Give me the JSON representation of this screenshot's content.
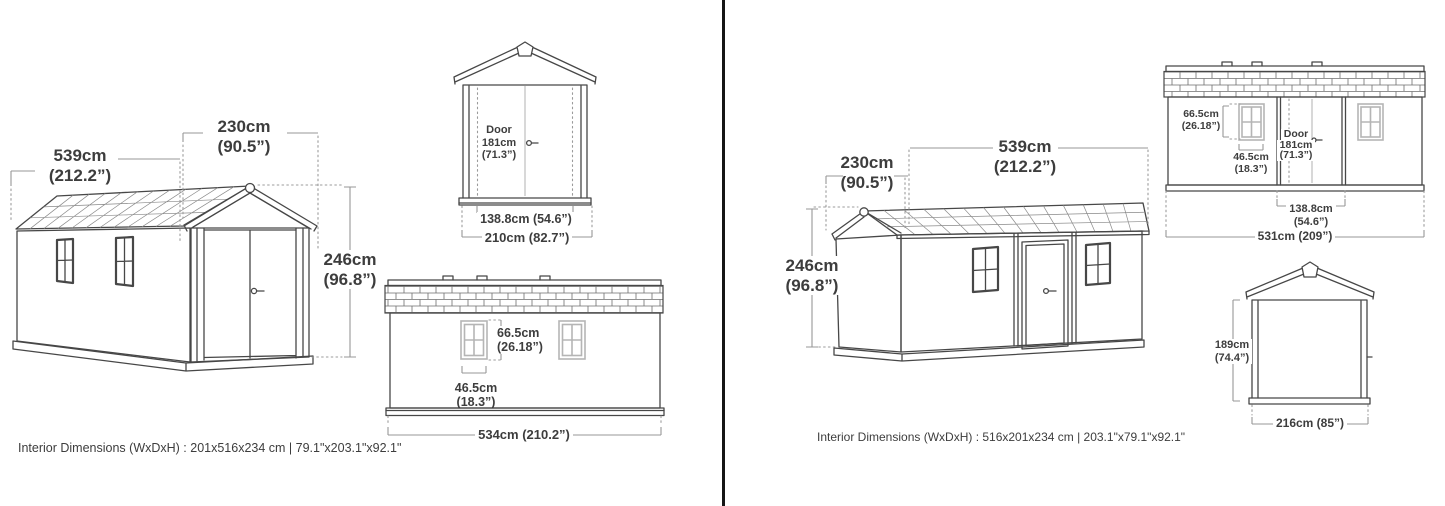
{
  "left": {
    "iso": {
      "length_cm": "539cm",
      "length_in": "(212.2”)",
      "width_cm": "230cm",
      "width_in": "(90.5”)",
      "height_cm": "246cm",
      "height_in": "(96.8”)"
    },
    "front": {
      "door_title": "Door",
      "door_height": "181cm",
      "door_height_in": "(71.3”)",
      "door_width": "138.8cm (54.6”)",
      "overall_width": "210cm (82.7”)"
    },
    "side": {
      "window_height": "66.5cm",
      "window_height_in": "(26.18”)",
      "window_width": "46.5cm",
      "window_width_in": "(18.3”)",
      "overall_length": "534cm (210.2”)"
    },
    "footer": "Interior Dimensions (WxDxH) : 201x516x234 cm | 79.1\"x203.1\"x92.1\""
  },
  "right": {
    "iso": {
      "width_cm": "230cm",
      "width_in": "(90.5”)",
      "length_cm": "539cm",
      "length_in": "(212.2”)",
      "height_cm": "246cm",
      "height_in": "(96.8”)"
    },
    "side": {
      "window_height": "66.5cm",
      "window_height_in": "(26.18”)",
      "window_width": "46.5cm",
      "window_width_in": "(18.3”)",
      "door_title": "Door",
      "door_height": "181cm",
      "door_height_in": "(71.3”)",
      "door_width": "138.8cm",
      "door_width_in": "(54.6”)",
      "overall_length": "531cm (209”)"
    },
    "front": {
      "height_cm": "189cm",
      "height_in": "(74.4”)",
      "overall_width": "216cm (85”)"
    },
    "footer": "Interior Dimensions (WxDxH) : 516x201x234 cm | 203.1\"x79.1\"x92.1\""
  }
}
